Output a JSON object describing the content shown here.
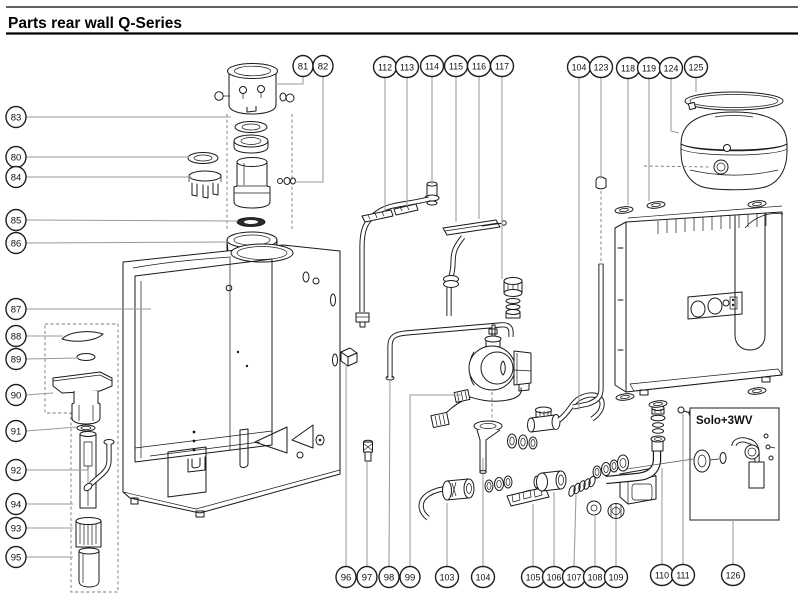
{
  "header": {
    "title": "Parts rear wall Q-Series"
  },
  "solo_box": {
    "label": "Solo+3WV"
  },
  "style": {
    "ink": "#1a1a1a",
    "leader": "#9a9a9a",
    "background": "#ffffff"
  },
  "callouts": [
    {
      "id": "81",
      "label": "81",
      "x": 303,
      "y": 66,
      "leader": [
        [
          303,
          76
        ],
        [
          303,
          84
        ],
        [
          275,
          84
        ]
      ]
    },
    {
      "id": "82",
      "label": "82",
      "x": 323,
      "y": 66,
      "leader": [
        [
          323,
          76
        ],
        [
          323,
          182
        ],
        [
          294,
          182
        ]
      ]
    },
    {
      "id": "112",
      "label": "112",
      "x": 385,
      "y": 67,
      "leader": [
        [
          385,
          77
        ],
        [
          385,
          212
        ]
      ]
    },
    {
      "id": "113",
      "label": "113",
      "x": 407,
      "y": 67,
      "leader": [
        [
          407,
          77
        ],
        [
          407,
          206
        ]
      ]
    },
    {
      "id": "114",
      "label": "114",
      "x": 432,
      "y": 66,
      "leader": [
        [
          432,
          76
        ],
        [
          432,
          184
        ]
      ]
    },
    {
      "id": "115",
      "label": "115",
      "x": 456,
      "y": 66,
      "leader": [
        [
          456,
          76
        ],
        [
          456,
          222
        ]
      ]
    },
    {
      "id": "116",
      "label": "116",
      "x": 479,
      "y": 66,
      "leader": [
        [
          479,
          76
        ],
        [
          479,
          219
        ]
      ]
    },
    {
      "id": "117",
      "label": "117",
      "x": 502,
      "y": 66,
      "leader": [
        [
          502,
          76
        ],
        [
          502,
          279
        ]
      ]
    },
    {
      "id": "104-top",
      "label": "104",
      "x": 579,
      "y": 67,
      "leader": [
        [
          579,
          77
        ],
        [
          579,
          410
        ]
      ]
    },
    {
      "id": "123",
      "label": "123",
      "x": 601,
      "y": 67,
      "leader": [
        [
          601,
          77
        ],
        [
          601,
          179
        ]
      ]
    },
    {
      "id": "118",
      "label": "118",
      "x": 628,
      "y": 68,
      "leader": [
        [
          628,
          78
        ],
        [
          628,
          205
        ]
      ]
    },
    {
      "id": "119",
      "label": "119",
      "x": 649,
      "y": 68,
      "leader": [
        [
          649,
          78
        ],
        [
          649,
          201
        ]
      ]
    },
    {
      "id": "124",
      "label": "124",
      "x": 671,
      "y": 68,
      "leader": [
        [
          671,
          78
        ],
        [
          671,
          131
        ],
        [
          679,
          133
        ]
      ]
    },
    {
      "id": "125",
      "label": "125",
      "x": 696,
      "y": 67,
      "leader": [
        [
          696,
          77
        ],
        [
          696,
          92
        ]
      ]
    },
    {
      "id": "83",
      "label": "83",
      "x": 16,
      "y": 117,
      "leader": [
        [
          26,
          117
        ],
        [
          231,
          117
        ]
      ]
    },
    {
      "id": "80",
      "label": "80",
      "x": 16,
      "y": 157,
      "leader": [
        [
          26,
          157
        ],
        [
          189,
          157
        ]
      ]
    },
    {
      "id": "84",
      "label": "84",
      "x": 16,
      "y": 177,
      "leader": [
        [
          26,
          177
        ],
        [
          191,
          177
        ]
      ]
    },
    {
      "id": "85",
      "label": "85",
      "x": 16,
      "y": 220,
      "leader": [
        [
          26,
          220
        ],
        [
          238,
          221
        ]
      ]
    },
    {
      "id": "86",
      "label": "86",
      "x": 16,
      "y": 243,
      "leader": [
        [
          26,
          243
        ],
        [
          228,
          242
        ]
      ]
    },
    {
      "id": "87",
      "label": "87",
      "x": 16,
      "y": 309,
      "leader": [
        [
          26,
          309
        ],
        [
          151,
          309
        ]
      ]
    },
    {
      "id": "88",
      "label": "88",
      "x": 16,
      "y": 336,
      "leader": [
        [
          26,
          336
        ],
        [
          63,
          336
        ]
      ]
    },
    {
      "id": "89",
      "label": "89",
      "x": 16,
      "y": 359,
      "leader": [
        [
          26,
          359
        ],
        [
          78,
          358
        ]
      ]
    },
    {
      "id": "90",
      "label": "90",
      "x": 16,
      "y": 395,
      "leader": [
        [
          26,
          395
        ],
        [
          53,
          393
        ]
      ]
    },
    {
      "id": "91",
      "label": "91",
      "x": 16,
      "y": 431,
      "leader": [
        [
          26,
          431
        ],
        [
          77,
          427
        ]
      ]
    },
    {
      "id": "92",
      "label": "92",
      "x": 16,
      "y": 470,
      "leader": [
        [
          26,
          470
        ],
        [
          88,
          470
        ],
        [
          88,
          483
        ]
      ]
    },
    {
      "id": "94",
      "label": "94",
      "x": 16,
      "y": 504,
      "leader": [
        [
          26,
          504
        ],
        [
          73,
          504
        ]
      ]
    },
    {
      "id": "93",
      "label": "93",
      "x": 16,
      "y": 528,
      "leader": [
        [
          26,
          528
        ],
        [
          73,
          528
        ]
      ]
    },
    {
      "id": "95",
      "label": "95",
      "x": 16,
      "y": 557,
      "leader": [
        [
          26,
          557
        ],
        [
          73,
          557
        ]
      ]
    },
    {
      "id": "96",
      "label": "96",
      "x": 346,
      "y": 577,
      "leader": [
        [
          346,
          566
        ],
        [
          346,
          364
        ]
      ]
    },
    {
      "id": "97",
      "label": "97",
      "x": 367,
      "y": 577,
      "leader": [
        [
          367,
          566
        ],
        [
          367,
          462
        ]
      ]
    },
    {
      "id": "98",
      "label": "98",
      "x": 389,
      "y": 577,
      "leader": [
        [
          389,
          566
        ],
        [
          390,
          380
        ]
      ]
    },
    {
      "id": "99",
      "label": "99",
      "x": 410,
      "y": 577,
      "leader": [
        [
          410,
          566
        ],
        [
          410,
          395
        ],
        [
          462,
          395
        ]
      ]
    },
    {
      "id": "103",
      "label": "103",
      "x": 447,
      "y": 577,
      "leader": [
        [
          447,
          566
        ],
        [
          447,
          503
        ]
      ]
    },
    {
      "id": "104-bottom",
      "label": "104",
      "x": 483,
      "y": 577,
      "leader": [
        [
          483,
          566
        ],
        [
          483,
          458
        ]
      ]
    },
    {
      "id": "105",
      "label": "105",
      "x": 533,
      "y": 577,
      "leader": [
        [
          533,
          566
        ],
        [
          533,
          504
        ]
      ]
    },
    {
      "id": "106",
      "label": "106",
      "x": 554,
      "y": 577,
      "leader": [
        [
          554,
          566
        ],
        [
          554,
          492
        ]
      ]
    },
    {
      "id": "107",
      "label": "107",
      "x": 574,
      "y": 577,
      "leader": [
        [
          574,
          566
        ],
        [
          576,
          495
        ]
      ]
    },
    {
      "id": "108",
      "label": "108",
      "x": 595,
      "y": 577,
      "leader": [
        [
          595,
          566
        ],
        [
          595,
          516
        ]
      ]
    },
    {
      "id": "109",
      "label": "109",
      "x": 616,
      "y": 577,
      "leader": [
        [
          616,
          566
        ],
        [
          616,
          519
        ]
      ]
    },
    {
      "id": "110",
      "label": "110",
      "x": 662,
      "y": 575,
      "leader": [
        [
          662,
          564
        ],
        [
          662,
          468
        ]
      ]
    },
    {
      "id": "111",
      "label": "111",
      "x": 683,
      "y": 575,
      "leader": [
        [
          683,
          564
        ],
        [
          683,
          414
        ]
      ]
    },
    {
      "id": "126",
      "label": "126",
      "x": 733,
      "y": 575,
      "leader": [
        [
          733,
          564
        ],
        [
          733,
          520
        ]
      ]
    }
  ]
}
